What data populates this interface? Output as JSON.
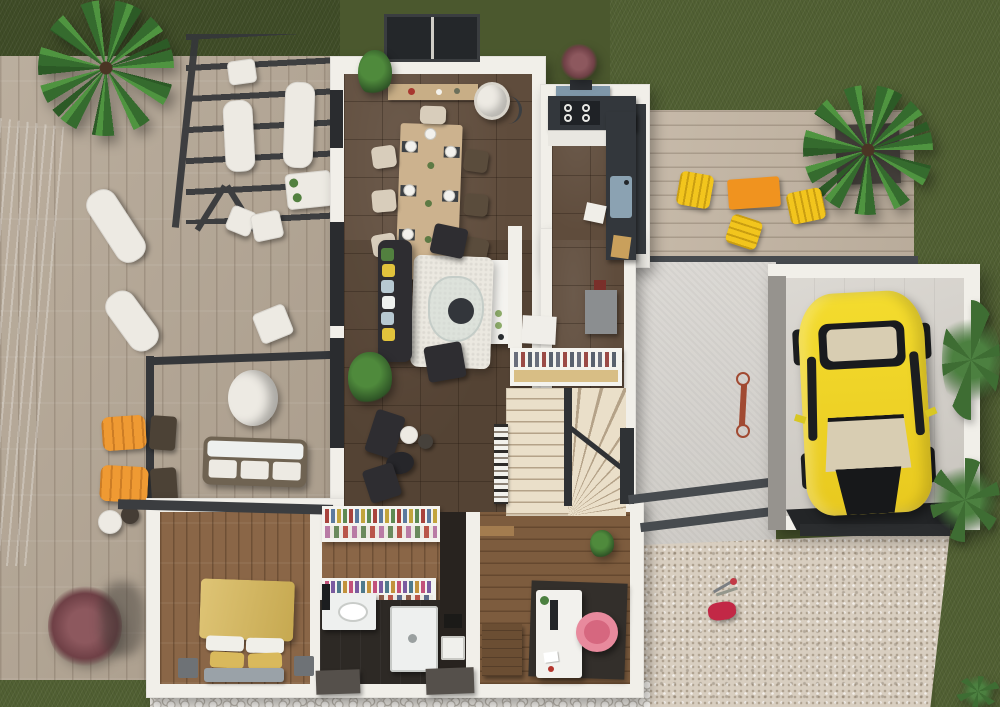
{
  "scene": {
    "type": "3d-floor-plan-render",
    "view": "top-down",
    "rooms": [
      "dining-room",
      "kitchen",
      "living-room",
      "entry-hall-stairs",
      "bedroom",
      "dressing",
      "bathroom",
      "office",
      "garage"
    ],
    "exterior": [
      "swimming-pool",
      "pool-deck",
      "pergola",
      "terrace",
      "side-deck",
      "driveway",
      "gravel-yard",
      "pebble-border",
      "lawn"
    ],
    "objects": [
      "palm-tree",
      "sun-loungers",
      "outdoor-sofa",
      "round-table",
      "dining-table-with-settings",
      "kitchen-counters",
      "cooktop",
      "sink",
      "island",
      "sofa-with-pillows",
      "coffee-table",
      "rug",
      "staircase",
      "coat-closet",
      "bookshelf",
      "double-bed",
      "clothes-racks",
      "vanity-sink",
      "shower",
      "desk",
      "monitor",
      "pink-chair",
      "yellow-sports-car",
      "bicycle",
      "yellow-patio-chairs",
      "orange-patio-table",
      "kids-toys",
      "red-bush"
    ]
  },
  "colors": {
    "grass_base": "#4b582e",
    "grass_dark": "#3f4c27",
    "grass_light": "#516033",
    "pool_water": "#a7d7d1",
    "pool_deep": "#8fc7c1",
    "deck_left": "#b3a593",
    "deck_right": "#c3b5a3",
    "wall_white": "#f1efe9",
    "tile_floor": "#5f4c3c",
    "wood_floor": "#8a6647",
    "office_wood": "#7d5c3e",
    "counter_dark": "#33373c",
    "hood_blue": "#7f97a9",
    "sink_blue": "#8ba2b2",
    "island_white": "#f4f3ef",
    "rug_white": "#ebe8e0",
    "sofa_dark": "#2e2d31",
    "pillow_yellow": "#e2c33c",
    "pillow_green": "#52803f",
    "pillow_blue": "#b7c9d2",
    "pillow_white": "#eef0ee",
    "table_wood": "#ccb28e",
    "chair_beige": "#d8cdbb",
    "chair_dark": "#5a4c3c",
    "stairs_light": "#eadfc9",
    "stairs_line": "#b4a288",
    "rail_dark": "#2f3134",
    "closet_wood": "#d8be85",
    "bed_yellow": "#d7b757",
    "bench_gray": "#9aa2a8",
    "bath_dark": "#2d2925",
    "concrete": "#d6d3ce",
    "garage_floor": "#d3cfc8",
    "garage_wall_gray": "#96938e",
    "threshold_dark": "#232527",
    "gravel": "#d8cec0",
    "pebble": "#e8e5df",
    "car_yellow": "#f0d82c",
    "car_glass": "#d8cdb2",
    "car_black": "#17181a",
    "lounger_orange": "#ef9a33",
    "patio_orange": "#f0931f",
    "patio_yellow": "#f2c51d",
    "pergola_dark": "#35373a",
    "beam_dark": "#474b4f",
    "bush_red": "#7b4a50",
    "toy_pink": "#c22846",
    "chair_pink": "#e88a9d",
    "bike_red": "#a14a32",
    "white_furn": "#edeae3",
    "dark_furn": "#3a3733",
    "appliance_gray": "#8b8e90"
  }
}
